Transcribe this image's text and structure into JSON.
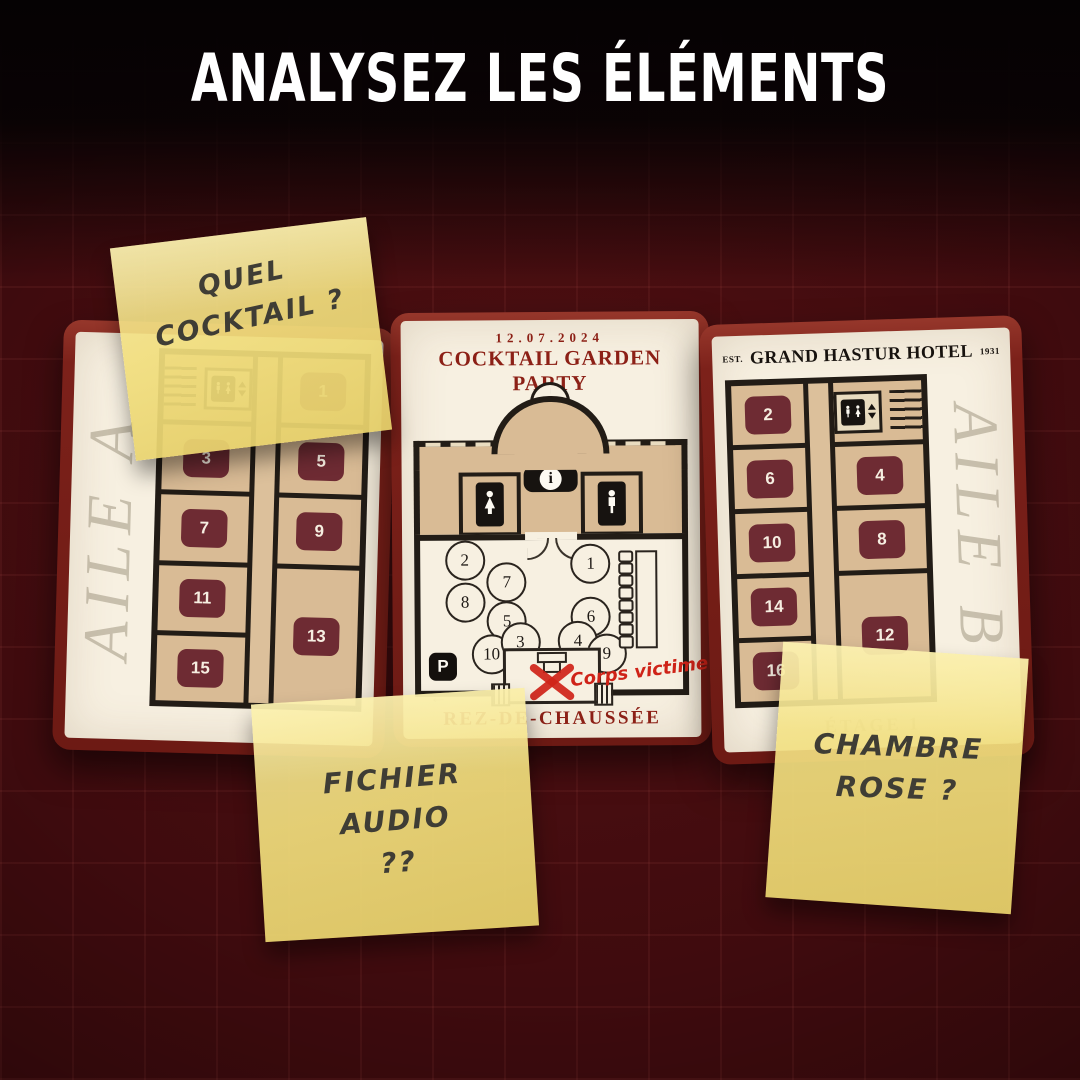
{
  "title": "ANALYSEZ LES ÉLÉMENTS",
  "wing_a": {
    "watermark": "AILE A",
    "rooms": {
      "r1": "1",
      "r3": "3",
      "r5": "5",
      "r7": "7",
      "r9": "9",
      "r11": "11",
      "r13": "13",
      "r15": "15"
    }
  },
  "ground_floor": {
    "date": "12.07.2024",
    "event_title": "COCKTAIL GARDEN PARTY",
    "info_symbol": "i",
    "parking_symbol": "P",
    "parking_arrow": "←",
    "victim_label": "Corps victime",
    "footer_label": "REZ-DE-CHAUSSÉE",
    "tables": {
      "t1": "1",
      "t2": "2",
      "t3": "3",
      "t4": "4",
      "t5": "5",
      "t6": "6",
      "t7": "7",
      "t8": "8",
      "t9": "9",
      "t10": "10"
    }
  },
  "wing_b": {
    "est_prefix": "EST.",
    "hotel_name": "GRAND HASTUR HOTEL",
    "est_year": "1931",
    "watermark": "AILE B",
    "floor_label": "ÉTAGE 1",
    "rooms": {
      "r2": "2",
      "r4": "4",
      "r6": "6",
      "r8": "8",
      "r10": "10",
      "r12": "12",
      "r14": "14",
      "r16": "16"
    }
  },
  "sticky_notes": {
    "note1": {
      "line1": "QUEL",
      "line2": "COCKTAIL ?"
    },
    "note2": {
      "line1": "FICHIER",
      "line2": "AUDIO",
      "line3": "??"
    },
    "note3": {
      "line1": "CHAMBRE",
      "line2": "ROSE ?"
    }
  },
  "colors": {
    "background": "#3f0b0e",
    "card_frame": "#7c211a",
    "paper": "#f7f0e1",
    "room_fill": "#d9bb95",
    "wall": "#221c16",
    "room_badge": "#6e2b33",
    "dark_red_text": "#8c2016",
    "accent_red": "#cf2318",
    "sticky_yellow": "#efdc80",
    "title_text": "#ffffff"
  }
}
